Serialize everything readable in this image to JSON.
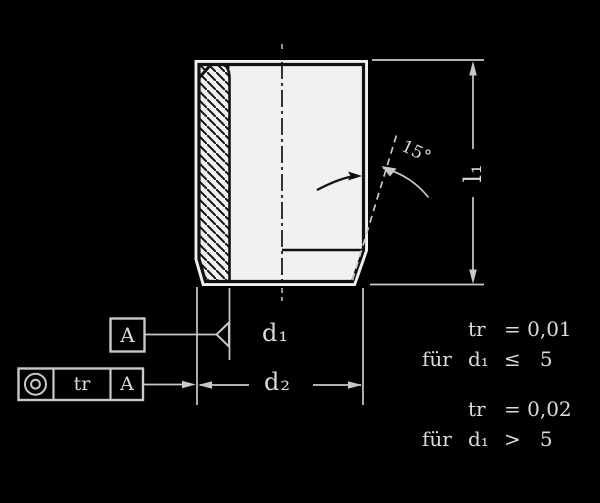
{
  "drawing": {
    "labels": {
      "d1": "d₁",
      "d2": "d₂",
      "l1": "l₁",
      "angle": "15°"
    },
    "datum": {
      "letter": "A"
    },
    "tolerance_frame": {
      "symbol": "concentricity",
      "tolerance": "tr",
      "datum_ref": "A"
    },
    "notes": [
      {
        "label": "",
        "formula": "tr",
        "value": "= 0,01"
      },
      {
        "label": "für",
        "formula": "d₁",
        "value": "≤   5"
      },
      {
        "label": "",
        "formula": "tr",
        "value": "= 0,02"
      },
      {
        "label": "für",
        "formula": "d₁",
        "value": ">   5"
      }
    ],
    "colors": {
      "background": "#000000",
      "line": "#c9c9c9",
      "text": "#dcdcdc",
      "part_fill": "#f1f1f1",
      "part_line": "#111111"
    }
  }
}
